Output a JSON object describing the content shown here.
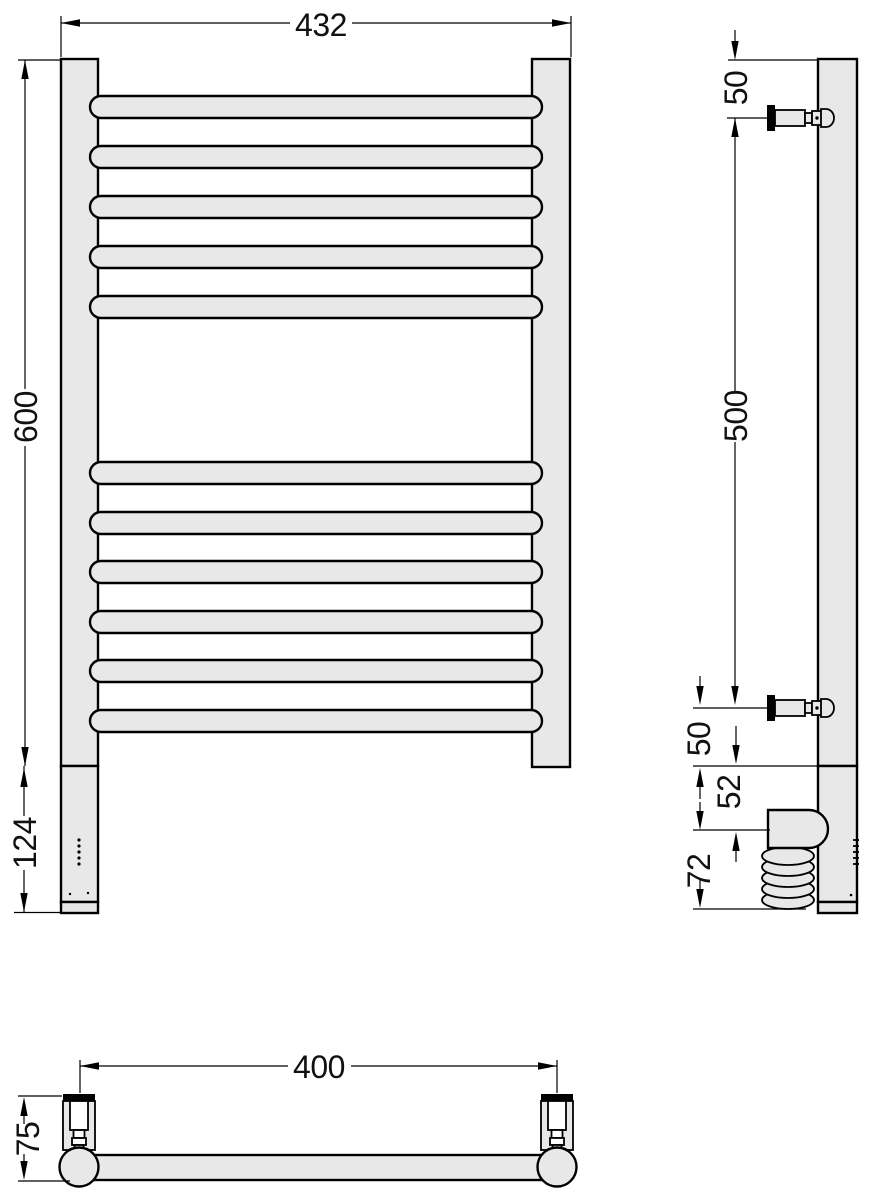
{
  "title": "Heated towel rail — dimensional technical drawing, three views",
  "colors": {
    "metal_fill": "#e8e8e8",
    "line": "#000000",
    "background": "#ffffff"
  },
  "front_view": {
    "width": "432",
    "height": "600",
    "heater_height": "124",
    "top_bar_count": 5,
    "bottom_bar_count": 6,
    "indicator_dot_count": 5
  },
  "side_view": {
    "top_to_bracket": "50",
    "bracket_to_bracket": "500",
    "bracket_to_body_end": "50",
    "body_to_element": "52",
    "element_height": "72"
  },
  "bottom_view": {
    "bracket_centers": "400",
    "wall_to_front": "75"
  }
}
